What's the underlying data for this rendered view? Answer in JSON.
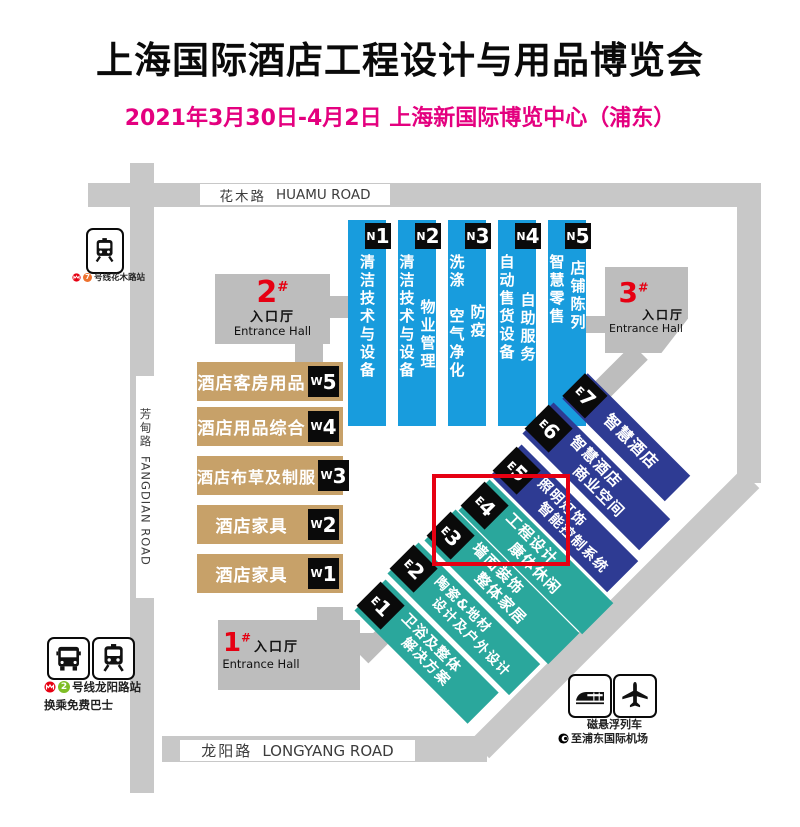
{
  "header": {
    "title": "上海国际酒店工程设计与用品博览会",
    "subtitle": "2021年3月30日-4月2日 上海新国际博览中心（浦东）"
  },
  "roads": {
    "huamu": {
      "zh": "花木路",
      "en": "HUAMU ROAD"
    },
    "fangdian": {
      "zh": "芳甸路",
      "en": "FANGDIAN ROAD"
    },
    "longyang": {
      "zh": "龙阳路",
      "en": "LONGYANG ROAD"
    }
  },
  "entrances": {
    "e1": {
      "num": "1",
      "hash": "#",
      "zh": "入口厅",
      "en": "Entrance Hall"
    },
    "e2": {
      "num": "2",
      "hash": "#",
      "zh": "入口厅",
      "en": "Entrance Hall"
    },
    "e3": {
      "num": "3",
      "hash": "#",
      "zh": "入口厅",
      "en": "Entrance Hall"
    }
  },
  "north_halls": [
    {
      "letter": "N",
      "digit": "1",
      "col1": "清洁技术与设备",
      "col1b": "",
      "col2": ""
    },
    {
      "letter": "N",
      "digit": "2",
      "col1": "清洁技术与设备",
      "col1b": "",
      "col2": "物业管理"
    },
    {
      "letter": "N",
      "digit": "3",
      "col1": "洗涤",
      "col1b": "空气净化",
      "col2": "防疫"
    },
    {
      "letter": "N",
      "digit": "4",
      "col1": "自动售货设备",
      "col1b": "",
      "col2": "自助服务"
    },
    {
      "letter": "N",
      "digit": "5",
      "col1": "智慧零售",
      "col1b": "",
      "col2": "店铺陈列"
    }
  ],
  "west_halls": [
    {
      "letter": "W",
      "digit": "5",
      "label": "酒店客房用品"
    },
    {
      "letter": "W",
      "digit": "4",
      "label": "酒店用品综合"
    },
    {
      "letter": "W",
      "digit": "3",
      "label": "酒店布草及制服"
    },
    {
      "letter": "W",
      "digit": "2",
      "label": "酒店家具"
    },
    {
      "letter": "W",
      "digit": "1",
      "label": "酒店家具"
    }
  ],
  "east_halls": [
    {
      "letter": "E",
      "digit": "7",
      "line1": "智慧酒店",
      "line2": ""
    },
    {
      "letter": "E",
      "digit": "6",
      "line1": "智慧酒店",
      "line2": "商业空间"
    },
    {
      "letter": "E",
      "digit": "5",
      "line1": "照明灯饰",
      "line2": "智能控制系统"
    },
    {
      "letter": "E",
      "digit": "4",
      "line1": "工程设计",
      "line2": "康体休闲"
    },
    {
      "letter": "E",
      "digit": "3",
      "line1": "墙面装饰",
      "line2": "整体家居"
    },
    {
      "letter": "E",
      "digit": "2",
      "line1": "陶瓷&地材",
      "line2": "设计及户外设计"
    },
    {
      "letter": "E",
      "digit": "1",
      "line1": "卫浴及整体",
      "line2": "解决方案"
    }
  ],
  "transit": {
    "huamu_station": {
      "line": "7",
      "text": "号线花木路站"
    },
    "longyang_station": {
      "line": "2",
      "text": "号线龙阳路站",
      "text2": "换乘免费巴士"
    },
    "maglev": {
      "line1": "磁悬浮列车",
      "line2": "至浦东国际机场"
    }
  },
  "colors": {
    "north_blue": "#189CDD",
    "east_dark_blue": "#2E3B93",
    "east_teal": "#2AA79C",
    "west_tan": "#C7A169",
    "road_gray": "#C8C8C8",
    "hall_gray": "#BDBDBD",
    "highlight_red": "#E60012",
    "subtitle_pink": "#E4007F",
    "line7_orange": "#EE722E",
    "line2_green": "#7FBE26"
  }
}
